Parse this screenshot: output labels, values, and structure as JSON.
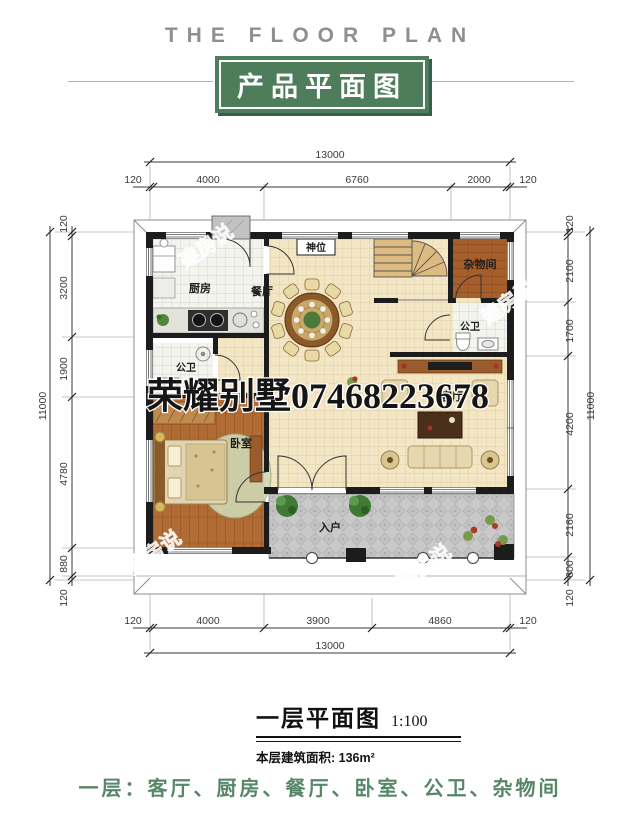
{
  "header": {
    "title_en": "THE FLOOR PLAN",
    "title_cn": "产品平面图"
  },
  "plan": {
    "rooms": {
      "kitchen": "厨房",
      "dining": "餐厅",
      "shrine": "神位",
      "storage": "杂物间",
      "bath_right": "公卫",
      "bath_left": "公卫",
      "bedroom": "卧室",
      "living": "客厅",
      "entrance": "入户"
    },
    "watermark_center": "荣耀别墅07468223678",
    "watermark_repeat": "建房说",
    "dims": {
      "top_total": "13000",
      "top_segments": [
        "120",
        "4000",
        "6760",
        "2000",
        "120"
      ],
      "left_total": "11000",
      "left_segments": [
        "120",
        "3200",
        "1900",
        "4780",
        "880",
        "120"
      ],
      "right_total": "11000",
      "right_segments": [
        "120",
        "2100",
        "1700",
        "4200",
        "2160",
        "600",
        "120"
      ],
      "bottom_total": "13000",
      "bottom_segments": [
        "120",
        "4000",
        "3900",
        "4860",
        "120"
      ]
    }
  },
  "caption": {
    "title": "一层平面图",
    "scale": "1:100",
    "area": "本层建筑面积: 136m²"
  },
  "footer": {
    "summary": "一层：客厅、厨房、餐厅、卧室、公卫、杂物间"
  }
}
